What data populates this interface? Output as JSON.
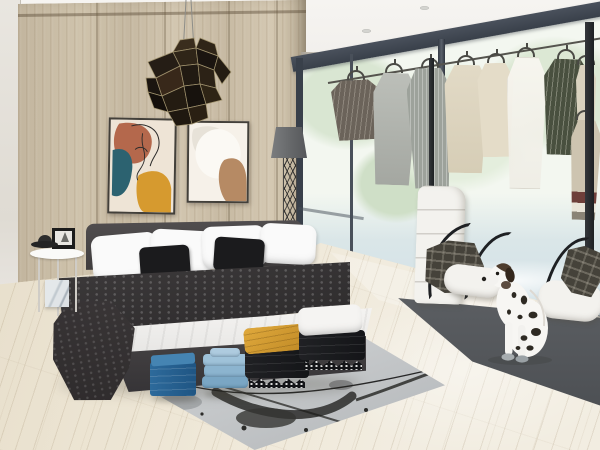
{
  "scene": {
    "title": "3D interior render - modern bedroom with open wardrobe, hanging clothes and a dalmatian dog",
    "description": "Photorealistic render of a bright bedroom: a light wood panel wall holds two abstract art prints beneath a dark faceted geometric pendant lamp; a charcoal double bed with white pillows, black cushions, dark duvet and folded white sheet stands beside a small round side table with a black picture frame and hat; stacks of folded clothes (dark blue, light blue, black with a mustard blanket, black with a white blanket) sit at the foot of the bed on a grey paint-splattered rug; floor-to-ceiling windows with dark frames show overexposed garden trees; a rail of hanging garments runs along the glass next to a dark clothes-rack pole; a white quilted lounge chair with draped plaid jackets and a second white seat stand on a dark grey rug where a dalmatian dog sits; a grey floor lamp with a lattice column stands by the wall; whitewashed wood plank flooring throughout.",
    "objects": [
      "wood panel wall",
      "geometric faceted pendant lamp",
      "abstract face line-art print",
      "abstract shapes art print",
      "floor lamp with lattice column",
      "double bed with dark bedding",
      "white pillows",
      "black cushions",
      "dark throw blanket",
      "round side table",
      "black picture frame",
      "black hat",
      "marble cube",
      "folded clothes stacks",
      "mustard folded blanket",
      "white folded blanket",
      "paint-splattered grey rug",
      "floor-to-ceiling windows",
      "garden trees view",
      "clothes rail with hanging garments",
      "clothes rack poles",
      "white quilted lounge chair",
      "white chaise seats",
      "plaid jackets",
      "dark grey rug",
      "dalmatian dog",
      "whitewashed plank floor",
      "ceiling spotlights"
    ]
  },
  "palette": {
    "ceiling": "#f4f2ef",
    "leftWallTone": "#e4e0d8",
    "woodLight": "#cbbfa9",
    "woodDark": "#b5a88f",
    "windowFrame": "#39404a",
    "glassTint": "#f3f7f0",
    "treeFoliage": "#d9e6d2",
    "lawnTint": "#dae6e8",
    "floorBase": "#ece4d3",
    "plankLine": "rgba(150,128,95,0.18)",
    "pendantDark": "#261e15",
    "pendantEdge": "#a2946f",
    "lampShade": "#66686a",
    "artCream": "#eee4d6",
    "artTerracotta": "#b4684c",
    "artTeal": "#2c6270",
    "artMustard": "#d69a2f",
    "artTan": "#b68a64",
    "bedFrame": "#403d3e",
    "duvetDark": "#2c2a2b",
    "sheetWhite": "#f4f3f1",
    "pillowWhite": "#fafafa",
    "cushionBlack": "#1b1b1d",
    "throwDark": "#2e2b2c",
    "tableWhite": "#fafaf8",
    "hatBlack": "#1c1c1c",
    "foldBlueDark": "#2d6a9b",
    "foldBlueLight": "#8fb6d0",
    "foldMustard": "#c08a26",
    "foldBlack": "#141518",
    "foldWhite": "#f5f4f2",
    "rugLightA": "#c2c5c7",
    "rugDark": "#4c4f53",
    "chairWhite": "#f3f2ee",
    "plaidBase": "#45423a",
    "gTaupe": "#6b635a",
    "gGrey": "#9da29b",
    "gCream": "#d6cdb6",
    "gBeige": "#e4dcc8",
    "gGreen": "#49503f",
    "gDress": "#cdc4b0",
    "hemMaroon": "#6e3f3a",
    "dogWhite": "#f7f6f3",
    "dogBrown": "#4e3d2e",
    "dogSpot": "#2e2a23"
  }
}
